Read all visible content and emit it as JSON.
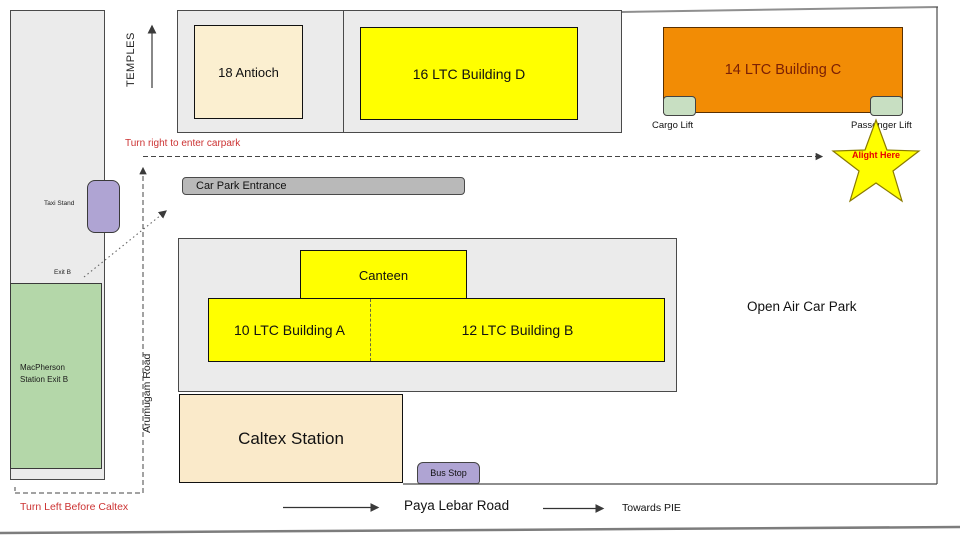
{
  "roads": {
    "temples": "TEMPLES",
    "arumugam": "Arumugam Road",
    "paya_lebar": "Paya Lebar Road",
    "towards_pie": "Towards PIE"
  },
  "buildings": {
    "antioch": "18 Antioch",
    "building_d": "16 LTC Building D",
    "building_c": "14 LTC Building C",
    "building_a": "10 LTC Building A",
    "building_b": "12 LTC Building B",
    "canteen": "Canteen",
    "caltex": "Caltex Station",
    "macpherson_line1": "MacPherson",
    "macpherson_line2": "Station Exit B"
  },
  "landmarks": {
    "taxi_stand": "Taxi Stand",
    "exit_b": "Exit B",
    "car_park_entrance": "Car Park Entrance",
    "cargo_lift": "Cargo Lift",
    "passenger_lift": "Passenger Lift",
    "bus_stop": "Bus Stop",
    "open_air_car_park": "Open Air Car Park"
  },
  "directions": {
    "turn_right": "Turn right to enter carpark",
    "turn_left": "Turn Left Before Caltex",
    "alight_here": "Alight Here"
  },
  "colors": {
    "yellow": "#FFFF00",
    "orange": "#F28C05",
    "beige": "#FBEFD0",
    "caltex_beige": "#FAEACA",
    "lift_green": "#C8DFC2",
    "station_green": "#B4D7A9",
    "purple": "#AFA4D3",
    "container_gray": "#EBEBEB",
    "entrance_gray": "#B9B9B9",
    "direction_red": "#CC3333",
    "alight_red": "#E80000"
  }
}
